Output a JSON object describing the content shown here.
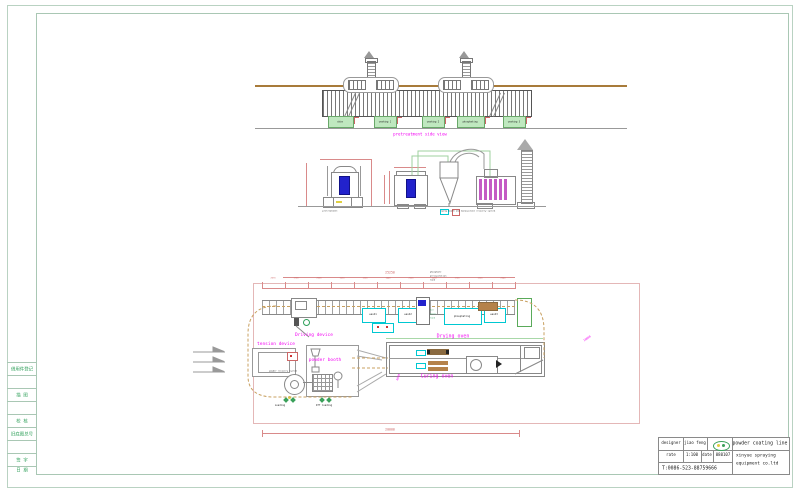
{
  "top_view": {
    "title": "pretreatment side view",
    "tank_labels": [
      "skim",
      "washing 1",
      "washing 2",
      "phosphating",
      "washing 3"
    ]
  },
  "elevations": {
    "pretreatment_label": "pretreatment",
    "spray_label": "spray booth and monocyclone recovery system"
  },
  "plan": {
    "total_dim": "25250",
    "seg_dims": [
      "2070",
      "1700",
      "2000",
      "1650",
      "1500",
      "1440",
      "2000",
      "1650",
      "1700",
      "1500",
      "2040"
    ],
    "precip_note": [
      "phosphate",
      "precipitation",
      "tank"
    ],
    "hot_tank_note": [
      "hot",
      "water",
      "tank"
    ],
    "tank_labels": [
      "wash1",
      "wash2",
      "phosphating",
      "wash3"
    ],
    "driving_label": "Driving device",
    "tension_label": "tension device",
    "powder_booth_label": "powder booth",
    "recovery_label": "powder recovery system",
    "drying_label": "Drying oven",
    "curing_label": "Curing oven",
    "loading_label": "Loading",
    "offloading_label": "Off loading",
    "bottom_dim": "20000",
    "rot_dim_1": "10000",
    "rot_dim_2": "6000"
  },
  "title_block": {
    "designer_label": "designer",
    "designer_value": "jiao feng",
    "scale_label": "rate",
    "scale_value": "1:100",
    "date_label": "date",
    "date_value": "080107",
    "phone": "T:0086-523-88759666",
    "product": "powder coating line",
    "company_line1": "xinyue spraying",
    "company_line2": "equipment co.ltd"
  },
  "margin_strip": {
    "rows": [
      "借用件登记",
      "描 图",
      "校 核",
      "旧底图总号",
      "签 字",
      "日 期"
    ]
  },
  "colors": {
    "magenta": "#f202f2",
    "dim_red": "#d98a8a",
    "tank_green_fill": "#bfe8bf",
    "cyan": "#00c8d2",
    "blue_fill": "#2222cc",
    "brown": "#a87b3a",
    "frame_green": "#a9c7b4",
    "filter_magenta": "#c45ac4"
  }
}
